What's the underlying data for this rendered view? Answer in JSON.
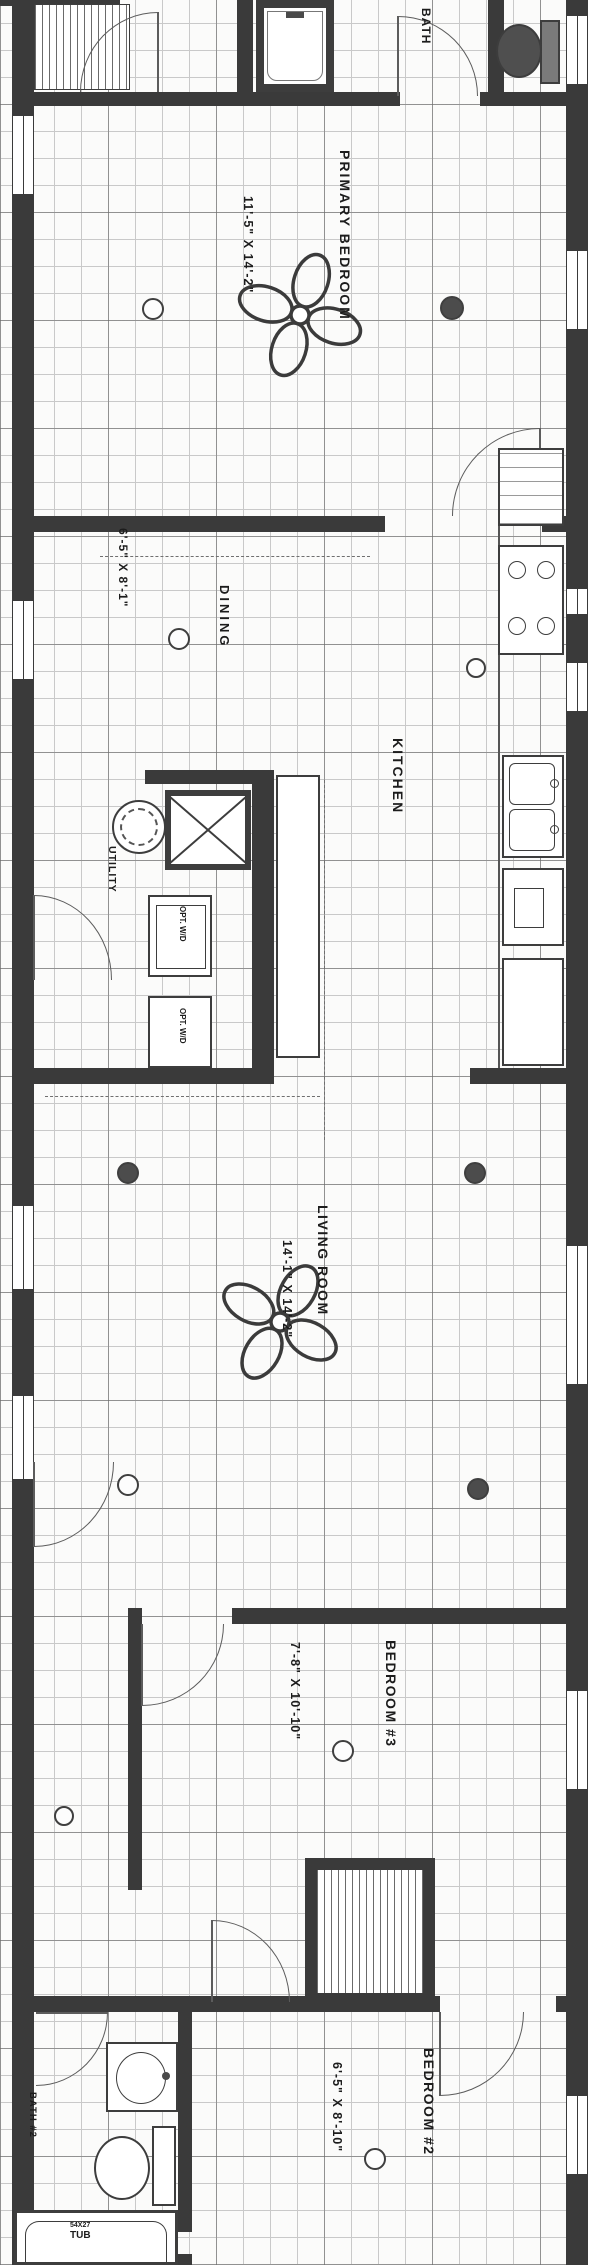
{
  "plan": {
    "rooms": {
      "primary_bedroom": {
        "name": "PRIMARY BEDROOM",
        "dims": "11'-5\" X 14'-2\""
      },
      "dining": {
        "name": "DINING",
        "dims": "6'-5\" X 8'-1\""
      },
      "kitchen": {
        "name": "KITCHEN"
      },
      "utility": {
        "name": "UTILITY"
      },
      "living_room": {
        "name": "LIVING ROOM",
        "dims": "14'-1\" X 14'-2\""
      },
      "bedroom_3": {
        "name": "BEDROOM #3",
        "dims": "7'-8\" X 10'-10\""
      },
      "bedroom_2": {
        "name": "BEDROOM #2",
        "dims": "6'-5\" X 8'-10\""
      },
      "bath": {
        "name": "BATH"
      },
      "bath_2": {
        "name": "BATH #2"
      }
    },
    "fixtures": {
      "washer_dryer_label": "OPT. W/D",
      "tub_size": "54X27",
      "tub_label": "TUB"
    },
    "colors": {
      "wall": "#3a3a3a",
      "ink": "#1c1c1c",
      "grid": "#c6c6c6"
    }
  }
}
